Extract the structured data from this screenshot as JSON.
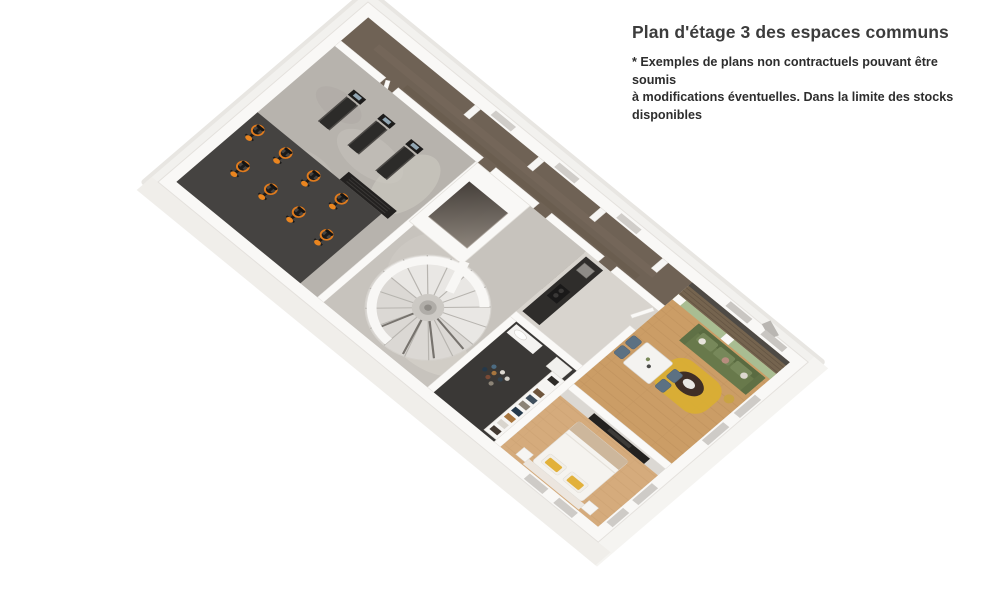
{
  "header": {
    "title": "Plan d'étage 3 des espaces communs",
    "disclaimer_line1": "* Exemples de plans non contractuels pouvant être soumis",
    "disclaimer_line2": "à modifications éventuelles. Dans la limite des stocks disponibles"
  },
  "floorplan": {
    "colors": {
      "corridor_carpet": "#6f6255",
      "gym_concrete": "#b7b3ad",
      "gym_mat": "#454341",
      "bike_accent_orange": "#e07b1d",
      "living_wood": "#cb9d66",
      "bedroom_wood": "#d5ab7c",
      "green_wall": "#a9bd92",
      "sofa_green": "#68794b",
      "rug_yellow": "#d9ae33",
      "balcony_deck": "#75644f",
      "laundry_floor": "#3a3836",
      "elevator_dark": "#4a443f",
      "wall_white": "#faf9f7",
      "stair_tread": "#e9e7e4",
      "window_glass": "#cecbc7"
    }
  }
}
